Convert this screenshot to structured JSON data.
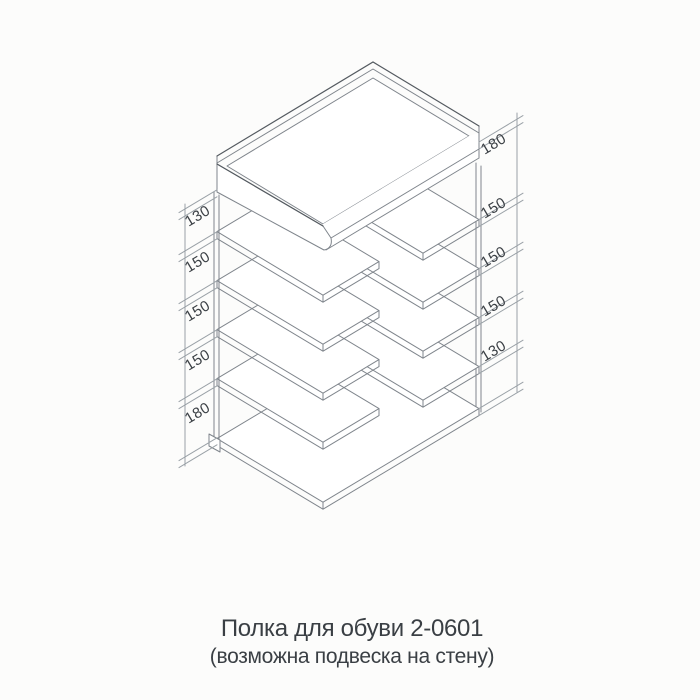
{
  "document": {
    "title_line1": "Полка для обуви 2-0601",
    "title_line2": "(возможна подвеска на стену)"
  },
  "dimensions": {
    "left": [
      "130",
      "150",
      "150",
      "150",
      "180"
    ],
    "right": [
      "180",
      "150",
      "150",
      "150",
      "130"
    ]
  },
  "colors": {
    "background": "#fcfcfb",
    "line": "#7f858c",
    "dim_line": "#9aa1a7",
    "accent_line": "#545a60",
    "text": "#3a3f44"
  }
}
